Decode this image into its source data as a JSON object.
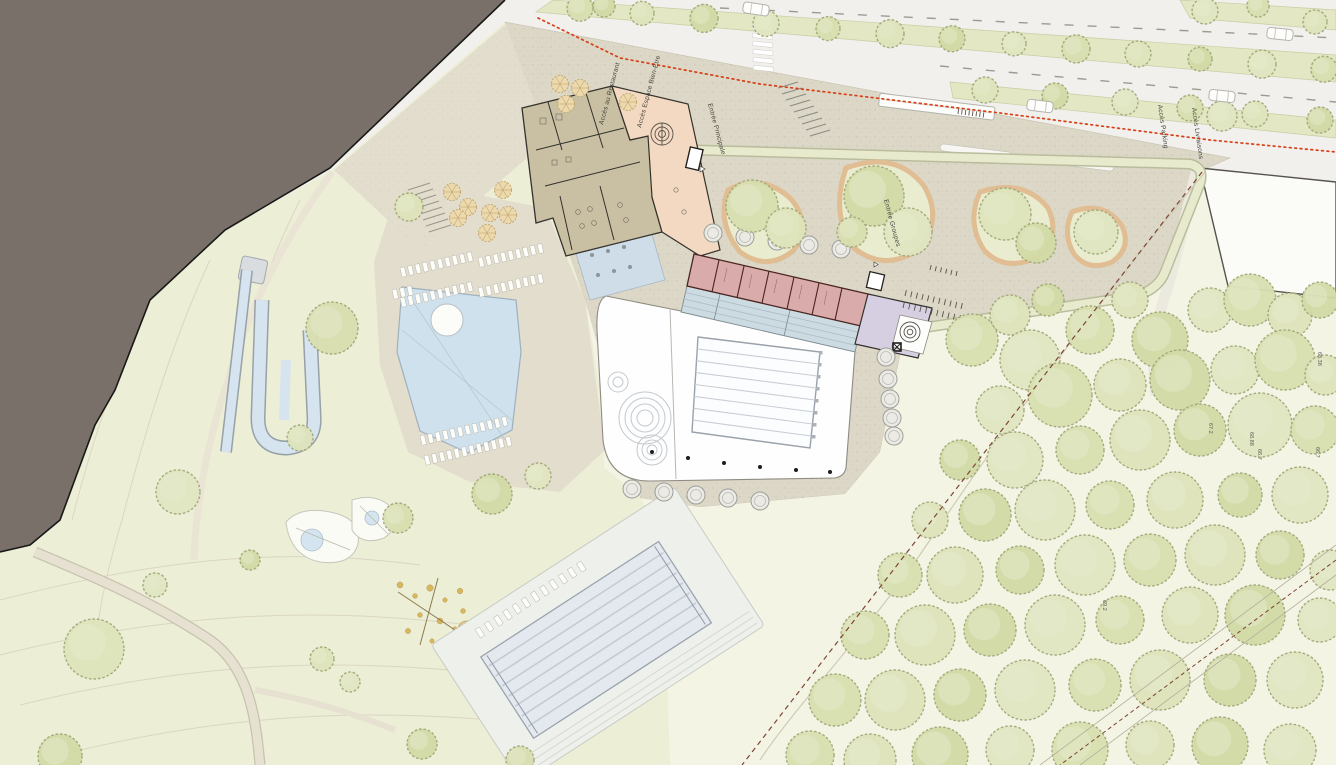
{
  "plan": {
    "labels": [
      {
        "id": "acces-restaurant",
        "text": "Accès au Restaurant",
        "x": 603,
        "y": 125,
        "rotation": -75
      },
      {
        "id": "acces-espace-bien-etre",
        "text": "Accès Espace Bien-Être",
        "x": 641,
        "y": 128,
        "rotation": -75
      },
      {
        "id": "entree-principale",
        "text": "Entrée Principale",
        "x": 708,
        "y": 104,
        "rotation": 75
      },
      {
        "id": "entree-groupes",
        "text": "Entrée Groupes",
        "x": 884,
        "y": 200,
        "rotation": 75
      },
      {
        "id": "acces-parking",
        "text": "Accès Parking",
        "x": 1158,
        "y": 105,
        "rotation": 82
      },
      {
        "id": "acces-livraisons",
        "text": "Accès Livraisons",
        "x": 1192,
        "y": 108,
        "rotation": 82
      }
    ],
    "spot_elevations": [
      {
        "value": "68.38",
        "x": 1318,
        "y": 352
      },
      {
        "value": "67.2",
        "x": 1209,
        "y": 423
      },
      {
        "value": "68.88",
        "x": 1250,
        "y": 432
      },
      {
        "value": "66.7",
        "x": 1258,
        "y": 449
      },
      {
        "value": "66.7",
        "x": 1316,
        "y": 447
      },
      {
        "value": "69.2",
        "x": 1103,
        "y": 600
      }
    ],
    "colors": {
      "context_dark": "#797169",
      "park_green": "#edeed6",
      "lawn_green": "#f3f4e3",
      "plaza_beige": "#dcd7c6",
      "deck_beige": "#e2ddcd",
      "road_gray": "#f1f0ec",
      "median_green": "#e4e7c3",
      "tree_green": "#d8dfb0",
      "water_blue": "#cfe1ed",
      "building_tan": "#c9c0a3",
      "building_peach": "#f3d9c2",
      "building_pink": "#d9abab",
      "building_lavender": "#d6cee1",
      "grandstand_blue": "#ccdbe2",
      "alignment_red_dotted": "#d84018",
      "boundary_maroon_dashed": "#7d4535"
    }
  }
}
